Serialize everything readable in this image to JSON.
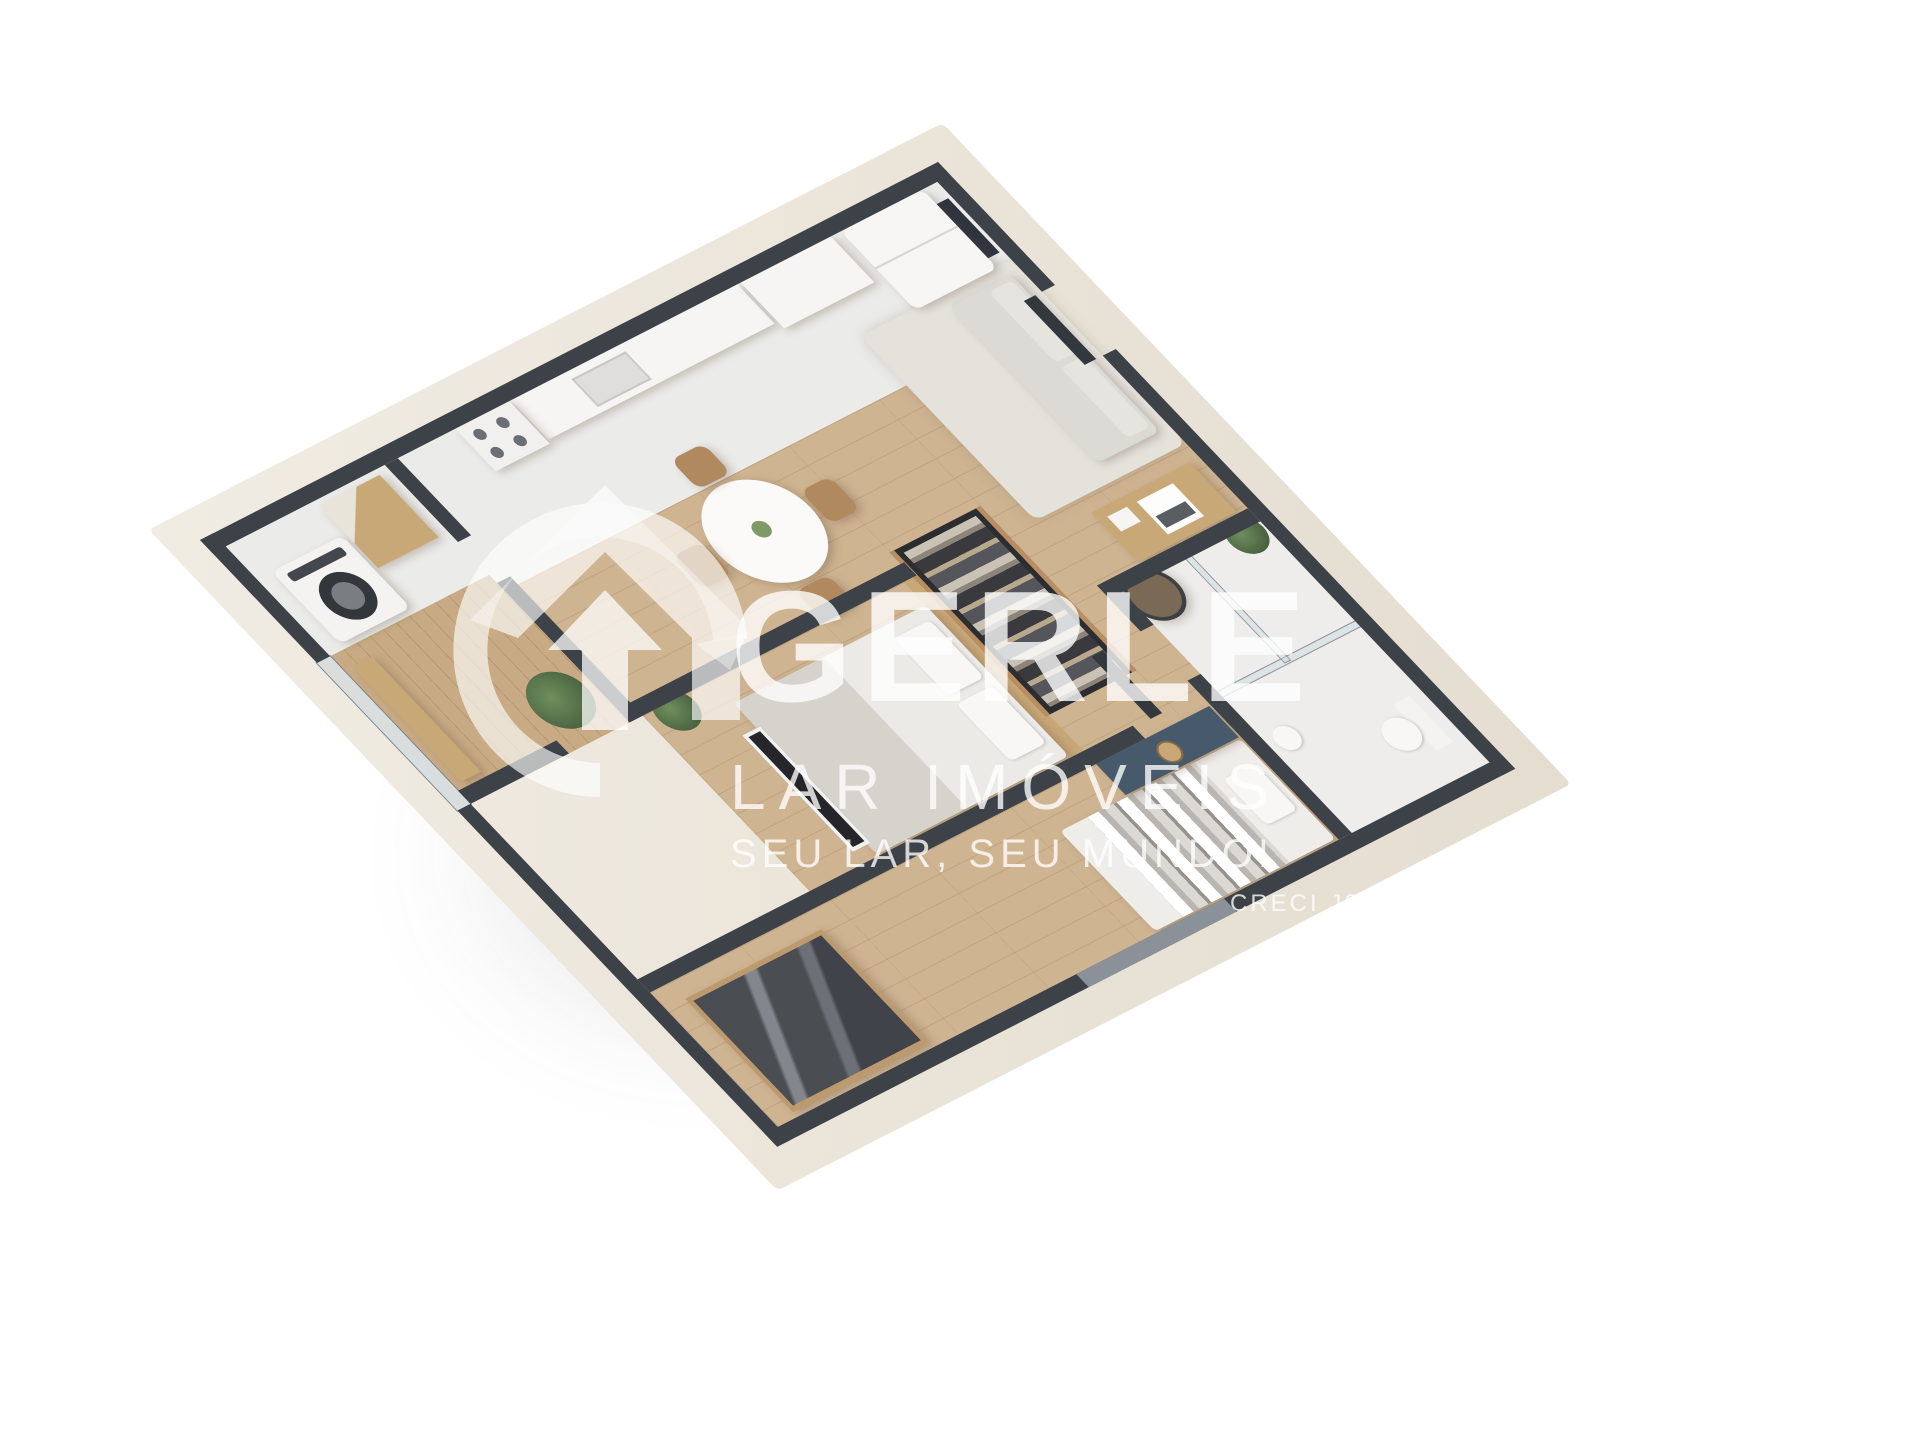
{
  "watermark": {
    "brand": "GERLE",
    "brand_sub": "LAR IMÓVEIS",
    "tagline": "SEU LAR, SEU MUNDO!",
    "license": "CRECI J2576",
    "logo_icon": "house-arrow-circle"
  },
  "colors": {
    "background": "#ffffff",
    "wall_top": "#3d4248",
    "wall_exterior_face": "#e9e3d9",
    "wood_floor": "#cfb492",
    "tile_floor": "#ebebe9",
    "balcony_floor": "#c8ab84",
    "rug": "#e5e2dc",
    "sofa": "#dcdad4",
    "furniture_wood": "#c9a878",
    "vanity_blue": "#475a6c",
    "plant_green": "#5f7d55",
    "watermark": "rgba(255,255,255,0.78)"
  }
}
